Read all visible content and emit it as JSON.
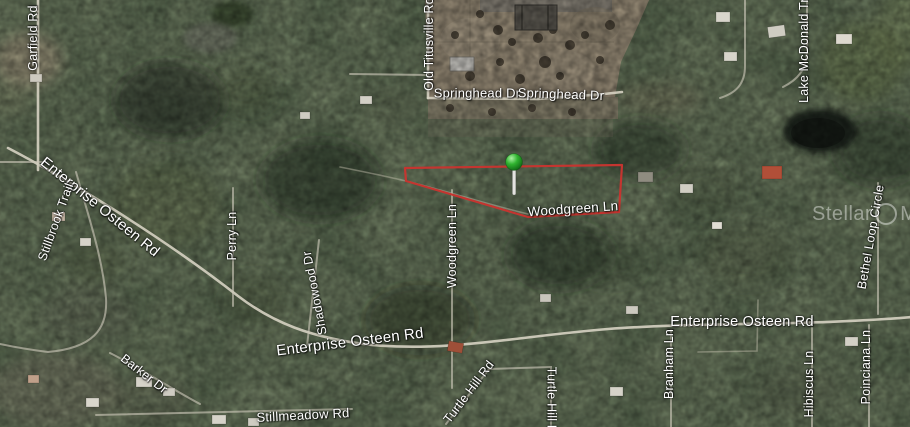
{
  "map": {
    "type_label": "satellite",
    "parcel": {
      "boundary_color": "#c43530",
      "marker_color": "#2fb32f",
      "marker_name": "green-pin"
    },
    "watermark": {
      "brand_left": "Stellar",
      "brand_right": "MLS"
    },
    "road_labels": {
      "garfield_rd": "Garfield Rd",
      "old_titusville_rd": "Old Titusville Rd",
      "springhead_dr_1": "Springhead Dr",
      "springhead_dr_2": "Springhead Dr",
      "lake_mcdonald_trail": "Lake McDonald Tra",
      "enterprise_osteen_rd_left": "Enterprise Osteen Rd",
      "stillbrook_trail": "Stillbrook Trail",
      "perry_ln": "Perry Ln",
      "shadowood_dr": "Shadowood Dr",
      "woodgreen_ln_vertical": "Woodgreen Ln",
      "woodgreen_ln_horizontal": "Woodgreen Ln",
      "enterprise_osteen_rd_right": "Enterprise Osteen Rd",
      "enterprise_osteen_rd_bottom": "Enterprise Osteen Rd",
      "barker_dr": "Barker Dr",
      "stillmeadow_rd": "Stillmeadow Rd",
      "turtle_hill_rd_diagonal": "Turtle Hill Rd",
      "turtle_hill_rd_vertical": "Turtle Hill Rd",
      "branham_ln": "Branham Ln",
      "hibiscus_ln": "Hibiscus Ln",
      "poinciana_ln": "Poinciana Ln",
      "bethel_loop_circle": "Bethel Loop Circle"
    }
  }
}
